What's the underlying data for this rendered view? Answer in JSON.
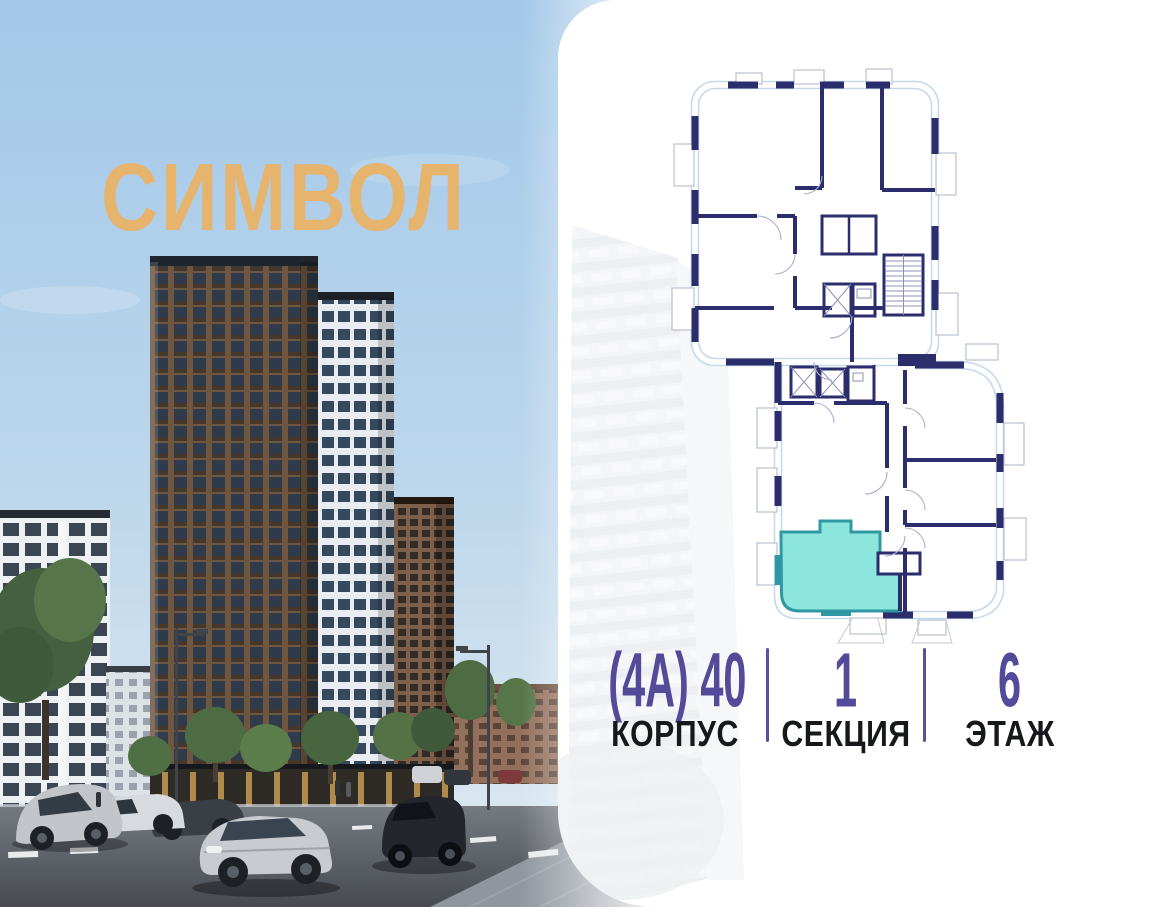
{
  "brand": {
    "logo": "СИМВОЛ",
    "logo_color": "#e6b46d"
  },
  "photo": {
    "description": "street-level render of residential towers",
    "sky_color": "#a5c9e8",
    "tower_color": "#6f5640"
  },
  "floor_plan": {
    "wall_color": "#2b2d6d",
    "outline_color": "#c5d9ea",
    "highlighted_unit": {
      "fill": "#8de6dd",
      "border": "#2f98a2",
      "status": "selected"
    }
  },
  "info": {
    "value_color": "#534a99",
    "label_color": "#17181c",
    "divider_color": "#59519e",
    "building": {
      "value": "(4А) 40",
      "label": "КОРПУС"
    },
    "section": {
      "value": "1",
      "label": "СЕКЦИЯ"
    },
    "floor": {
      "value": "6",
      "label": "ЭТАЖ"
    }
  }
}
